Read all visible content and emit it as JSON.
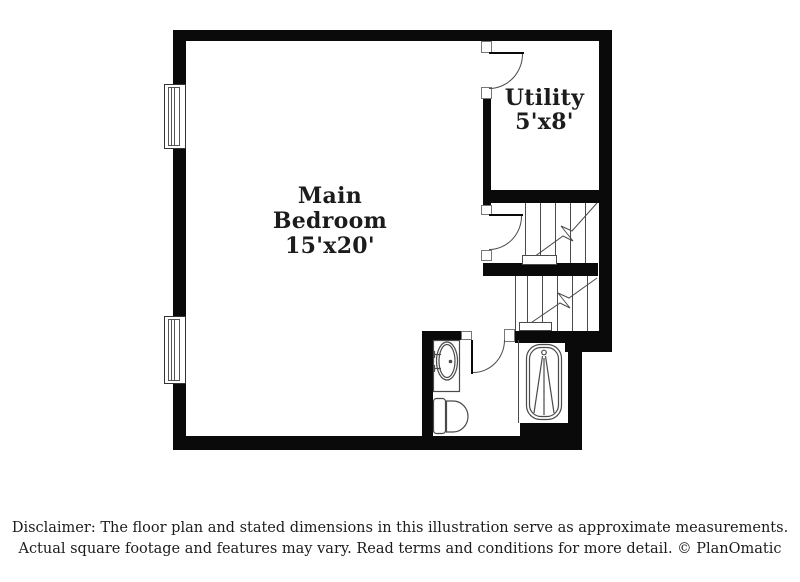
{
  "colors": {
    "bg": "#ffffff",
    "wall": "#0a0a0a",
    "line": "#4a4a4a",
    "text": "#1c1c1c"
  },
  "rooms": {
    "main_bedroom": {
      "line1": "Main",
      "line2": "Bedroom",
      "line3": "15'x20'"
    },
    "utility": {
      "line1": "Utility",
      "line2": "5'x8'"
    }
  },
  "disclaimer": {
    "line1": "Disclaimer: The floor plan and stated dimensions in this illustration serve as approximate measurements.",
    "line2": "Actual square footage and features may vary. Read terms and conditions for more detail. © PlanOmatic"
  }
}
